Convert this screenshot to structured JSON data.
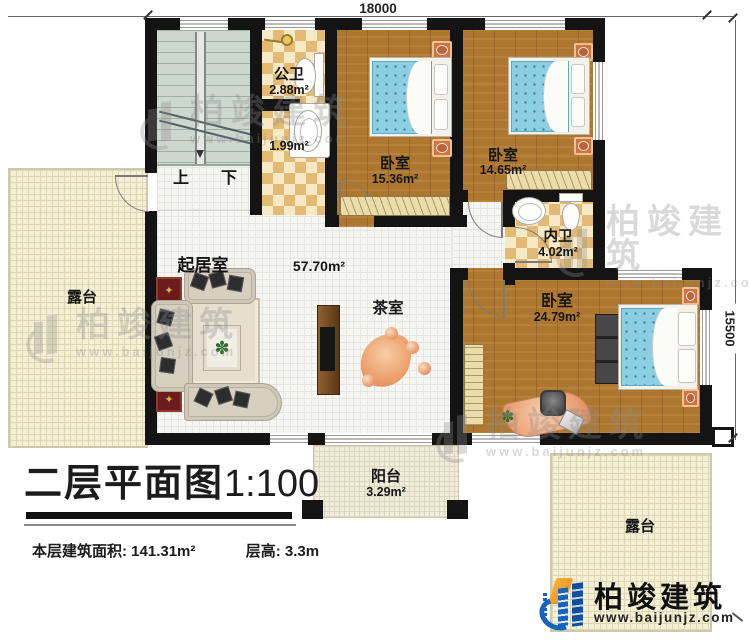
{
  "dimensions": {
    "top": "18000",
    "right": "15500"
  },
  "rooms": {
    "public_bath": {
      "label": "公卫",
      "area": "2.88m²"
    },
    "wash_area": {
      "area": "1.99m²"
    },
    "bedroom_a": {
      "label": "卧室",
      "area": "15.36m²"
    },
    "bedroom_b": {
      "label": "卧室",
      "area": "14.65m²"
    },
    "inner_bath": {
      "label": "内卫",
      "area": "4.02m²"
    },
    "master_bedroom": {
      "label": "卧室",
      "area": "24.79m²"
    },
    "living_room": {
      "label": "起居室",
      "area": "57.70m²"
    },
    "tea_room": {
      "label": "茶室"
    },
    "terrace_left": {
      "label": "露台"
    },
    "balcony": {
      "label": "阳台",
      "area": "3.29m²"
    },
    "terrace_right": {
      "label": "露台"
    }
  },
  "stairs": {
    "up": "上",
    "down": "下"
  },
  "title": {
    "text": "二层平面图",
    "scale": "1:100"
  },
  "stats": {
    "floor_area_label": "本层建筑面积:",
    "floor_area_value": "141.31m²",
    "floor_height_label": "层高:",
    "floor_height_value": "3.3m"
  },
  "logo": {
    "name": "柏竣建筑",
    "url": "www.baijunjz.com"
  },
  "watermark": {
    "name": "柏竣建筑",
    "url": "www.baijunjz.com"
  },
  "icons": {
    "plant": "✽",
    "ornament": "✦"
  },
  "colors": {
    "wall": "#141414",
    "wood_floor": "#ae7730",
    "mattress_blue": "#8ccfe2",
    "terrace_cream": "#f4f0d8",
    "brand_blue": "#1565c0",
    "brand_orange": "#f59b23"
  }
}
